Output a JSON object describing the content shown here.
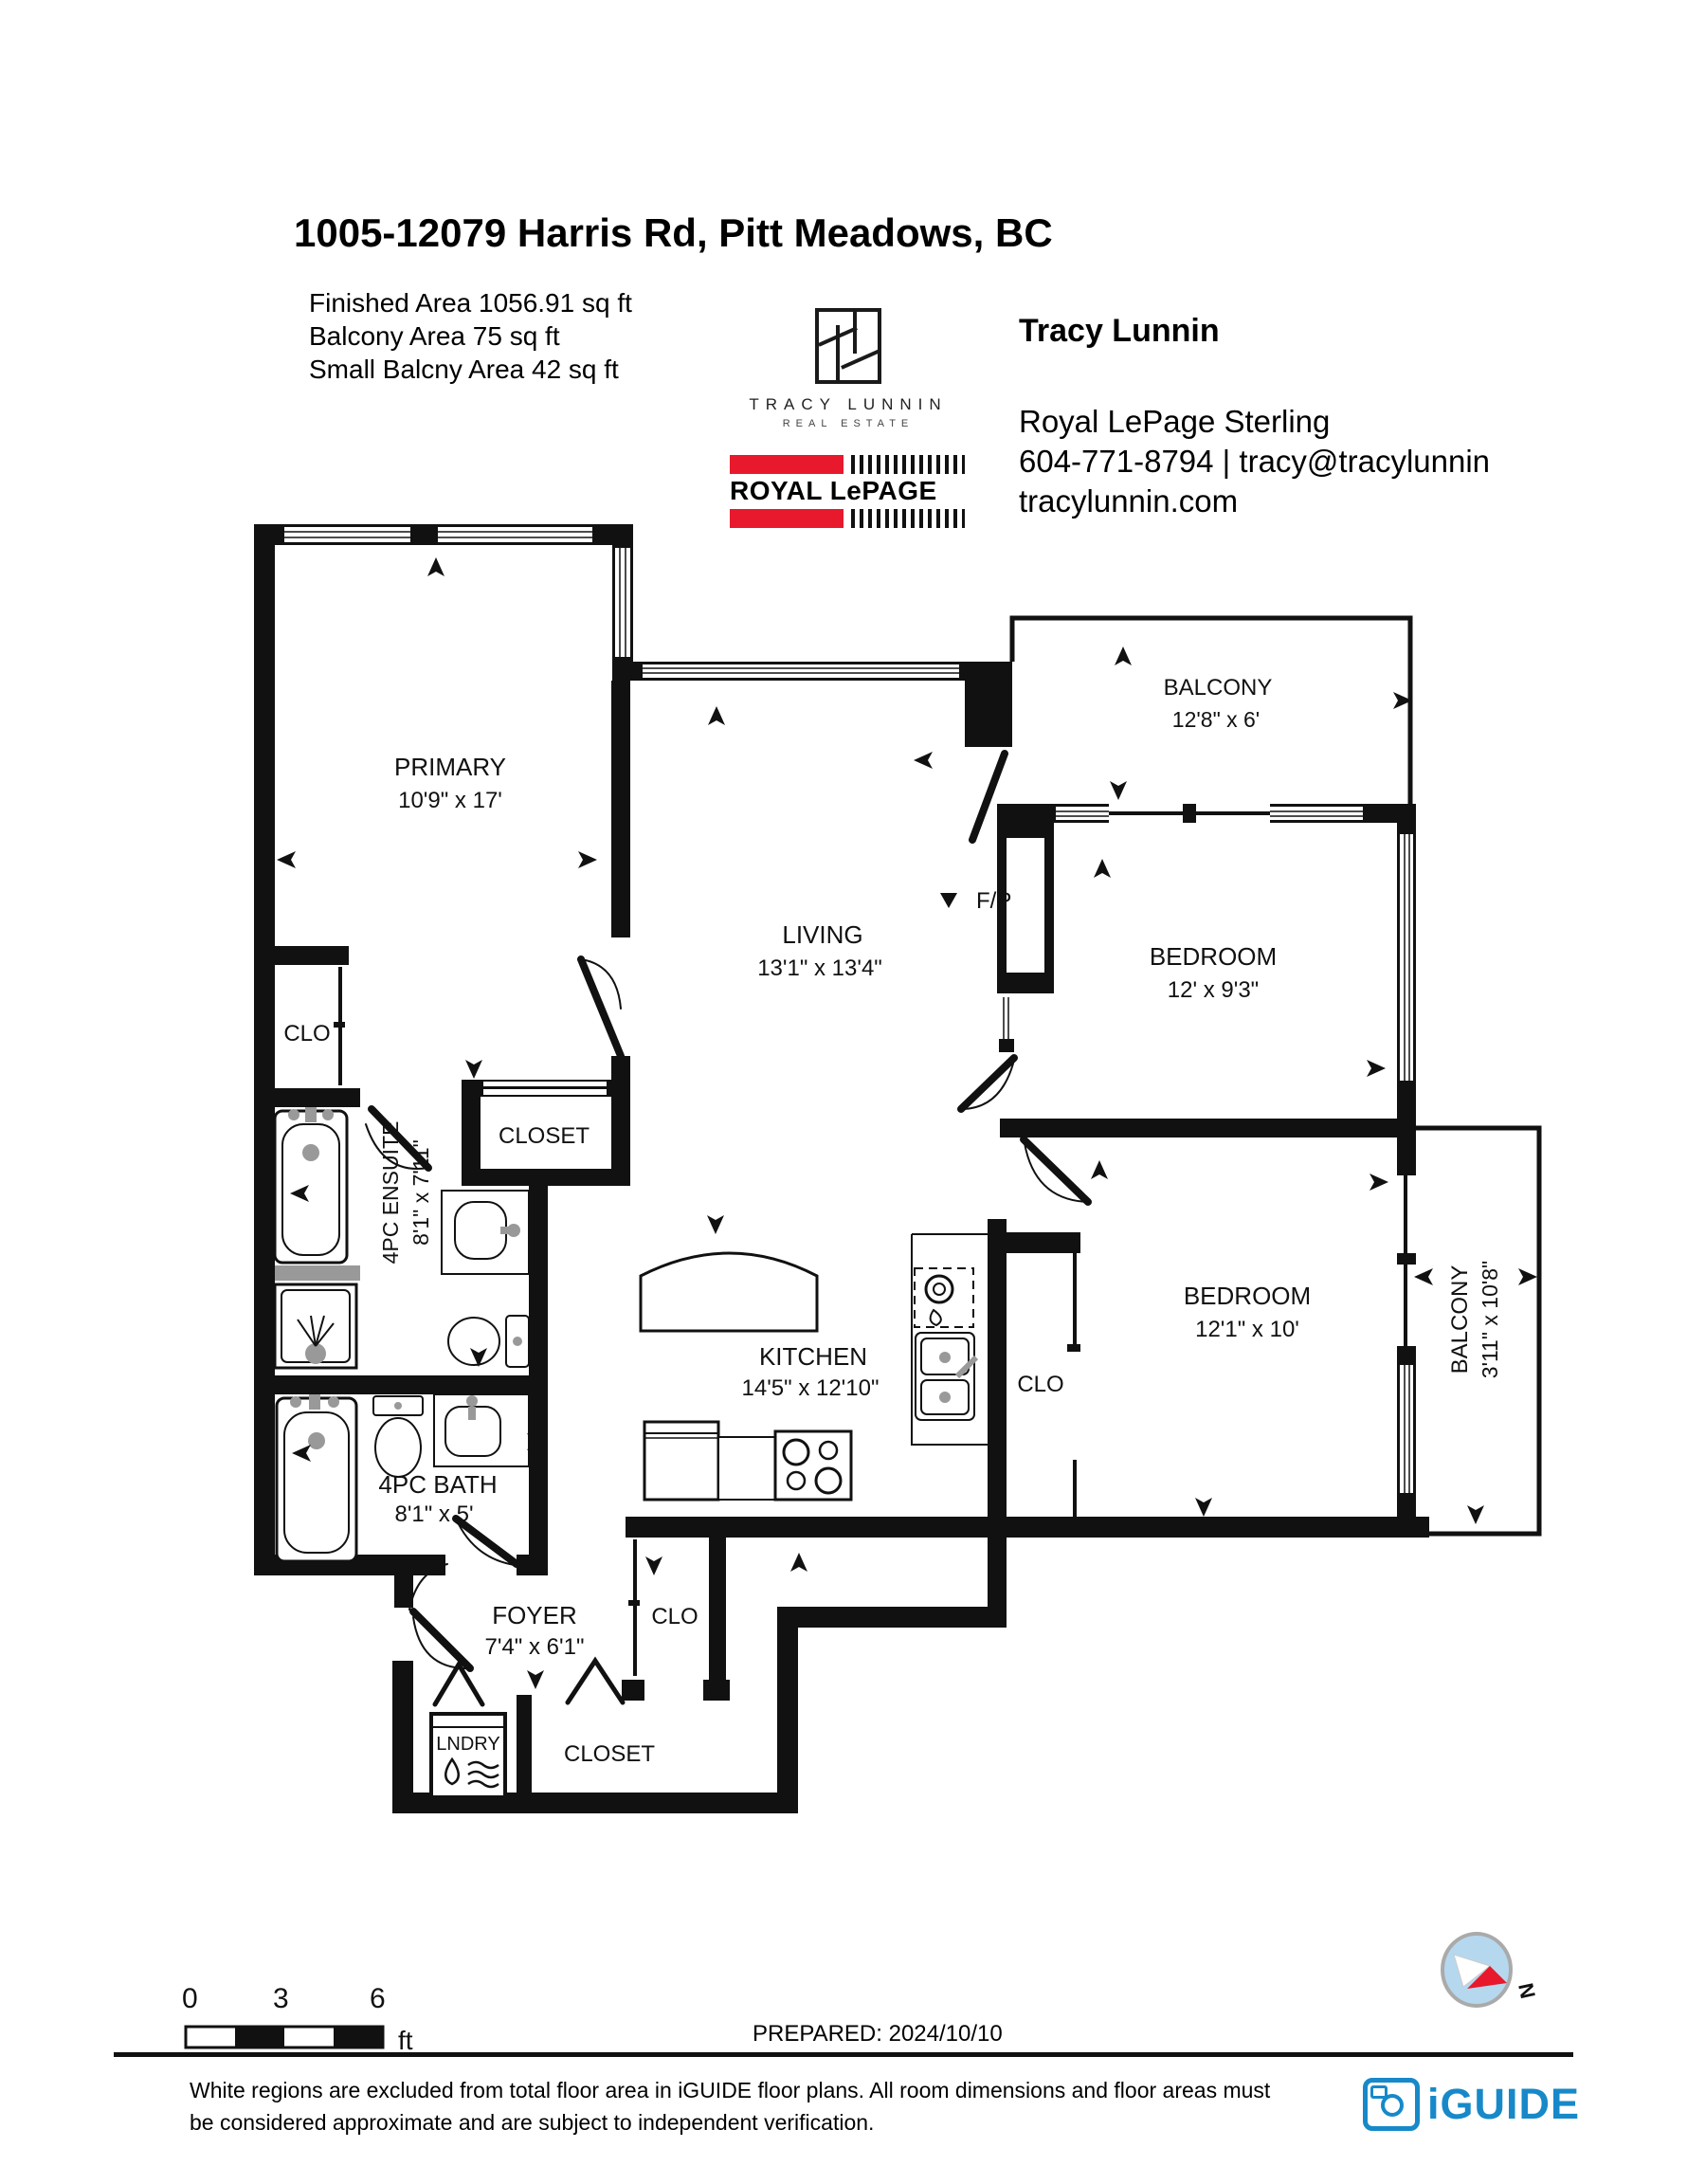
{
  "header": {
    "title": "1005-12079 Harris Rd, Pitt Meadows, BC",
    "areas": [
      "Finished Area 1056.91 sq ft",
      "Balcony Area 75 sq ft",
      "Small Balcny Area 42 sq ft"
    ],
    "tl_logo": {
      "line1": "TRACY LUNNIN",
      "line2": "REAL ESTATE"
    },
    "rlp_logo": {
      "text": "ROYAL LePAGE"
    },
    "agent": {
      "name": "Tracy Lunnin",
      "brokerage": "Royal LePage Sterling",
      "contact": "604-771-8794 | tracy@tracylunnin",
      "website": "tracylunnin.com"
    }
  },
  "rooms": {
    "primary": {
      "name": "PRIMARY",
      "dims": "10'9\" x 17'"
    },
    "living": {
      "name": "LIVING",
      "dims": "13'1\" x 13'4\""
    },
    "balcony_top": {
      "name": "BALCONY",
      "dims": "12'8\" x 6'"
    },
    "bedroom1": {
      "name": "BEDROOM",
      "dims": "12' x 9'3\""
    },
    "bedroom2": {
      "name": "BEDROOM",
      "dims": "12'1\" x 10'"
    },
    "balcony_right": {
      "name": "BALCONY",
      "dims": "3'11\" x 10'8\""
    },
    "kitchen": {
      "name": "KITCHEN",
      "dims": "14'5\" x 12'10\""
    },
    "ensuite": {
      "name": "4PC ENSUITE",
      "dims": "8'1\" x 7'11\""
    },
    "bath": {
      "name": "4PC BATH",
      "dims": "8'1\" x 5'"
    },
    "foyer": {
      "name": "FOYER",
      "dims": "7'4\" x 6'1\""
    },
    "closet_primary": "CLOSET",
    "closet_foyer": "CLOSET",
    "clo_primary": "CLO",
    "clo_foyer": "CLO",
    "clo_bedroom2": "CLO",
    "laundry": "LNDRY",
    "fireplace": "F/P"
  },
  "scale": {
    "zero": "0",
    "three": "3",
    "six": "6",
    "unit": "ft"
  },
  "prepared": "PREPARED: 2024/10/10",
  "compass": {
    "label": "N"
  },
  "footer": {
    "disclaimer1": "White regions are excluded from total floor area in iGUIDE floor plans. All room dimensions and floor areas must",
    "disclaimer2": "be considered approximate and are subject to independent verification.",
    "brand": "iGUIDE"
  },
  "colors": {
    "rlp_red": "#e8192c",
    "iguide_blue": "#1789c9",
    "compass_blue": "#b5d8ef"
  }
}
